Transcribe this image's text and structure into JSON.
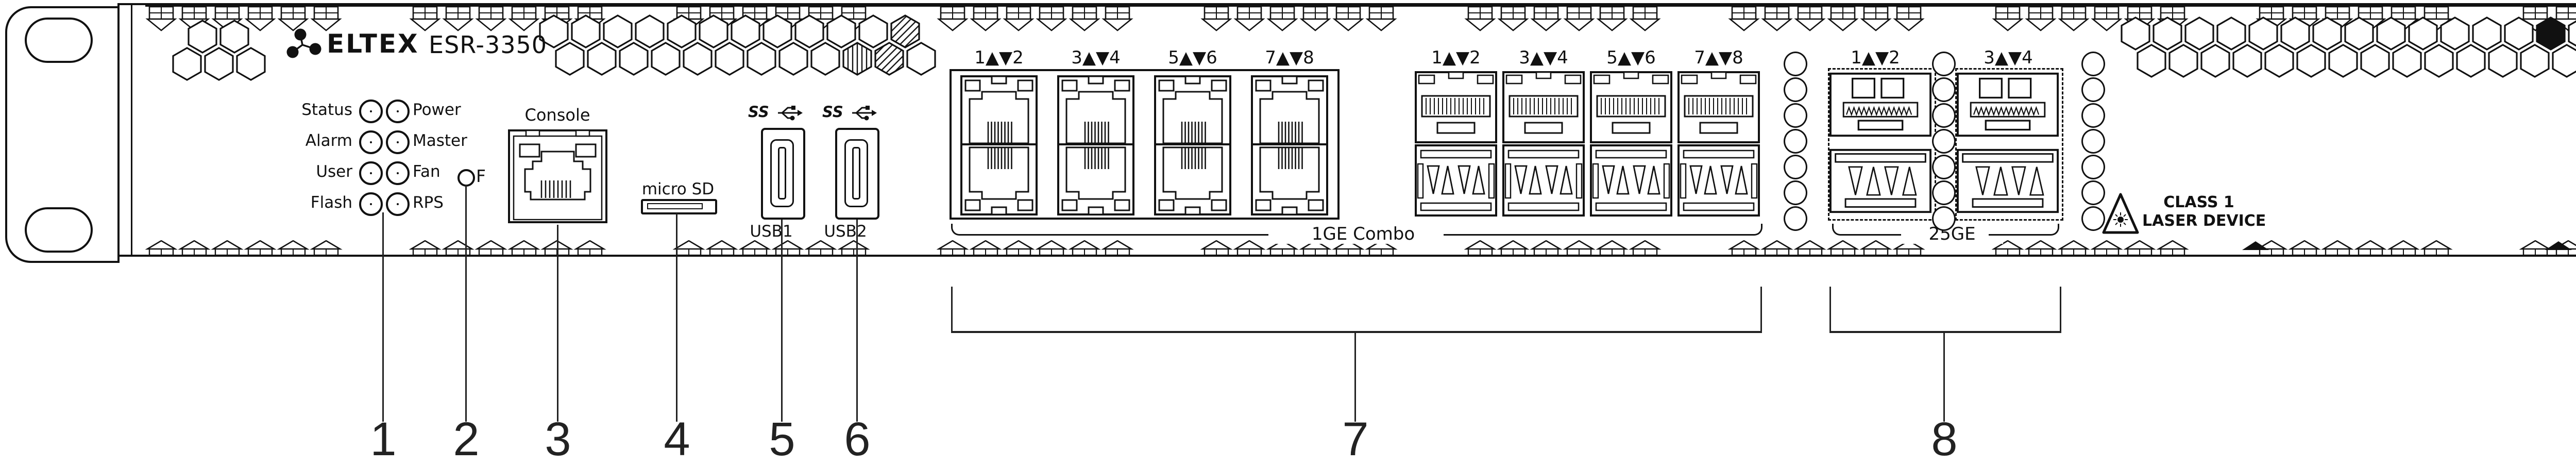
{
  "figure": {
    "brand": "ELTEX",
    "model": "ESR-3350",
    "leds": [
      {
        "left": "Status",
        "right": "Power"
      },
      {
        "left": "Alarm",
        "right": "Master"
      },
      {
        "left": "User",
        "right": "Fan"
      },
      {
        "left": "Flash",
        "right": "RPS"
      }
    ],
    "f_button": "F",
    "console": "Console",
    "micro_sd": "micro SD",
    "usb": [
      "USB1",
      "USB2"
    ],
    "usb_speed_mark": "SS",
    "combo_group": {
      "rj45_labels": [
        "1▲▼2",
        "3▲▼4",
        "5▲▼6",
        "7▲▼8"
      ],
      "sfp_labels": [
        "1▲▼2",
        "3▲▼4",
        "5▲▼6",
        "7▲▼8"
      ],
      "group_label": "1GE Combo"
    },
    "sfp28_group": {
      "labels": [
        "1▲▼2",
        "3▲▼4"
      ],
      "group_label": "25GE"
    },
    "laser_warning": {
      "line1": "CLASS 1",
      "line2": "LASER DEVICE"
    },
    "callouts": [
      "1",
      "2",
      "3",
      "4",
      "5",
      "6",
      "7",
      "8"
    ],
    "colors": {
      "line": "#111111",
      "background": "#ffffff"
    }
  }
}
